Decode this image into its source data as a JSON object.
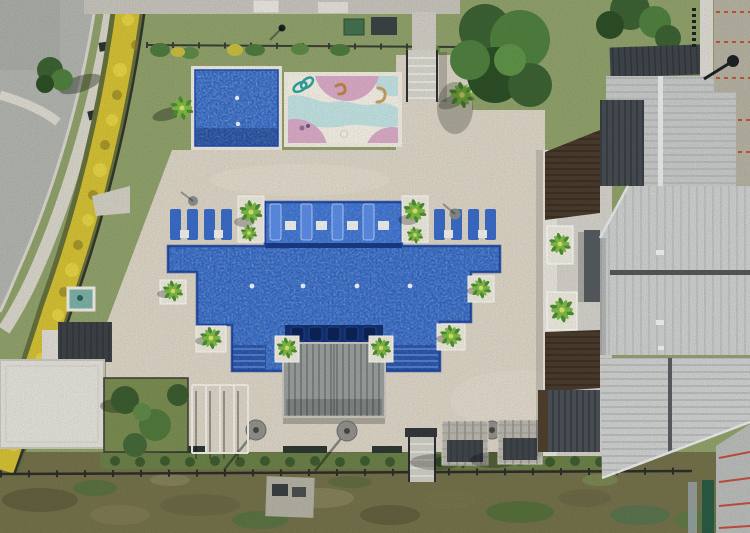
{
  "image": {
    "title": "Aerial drone photo of a residential amenity pool area",
    "view": "top-down",
    "width_px": 750,
    "height_px": 533
  },
  "palette": {
    "grass": "#90a26c",
    "scrub": "#74714b",
    "deck": "#dcd5c6",
    "road": "#b2b4af",
    "sidewalk": "#d8d5ca",
    "pool_blue": "#2a63cf",
    "pool_dark": "#16387f",
    "splash_base": "#f3efe3",
    "splash_pink": "#d9abc6",
    "splash_blue": "#c2e2e2",
    "hedge_yellow": "#d4c135",
    "hedge_green": "#66713c",
    "roof_light": "#cdd0cf",
    "roof_mid": "#c7cac9",
    "roof_dark": "#40464c",
    "roof_brown": "#4a3b2d",
    "wall_tan": "#b6b2a2",
    "white_roof": "#e3e1da",
    "spa_teal": "#7cb0a6",
    "lounger_blue": "#3b6cc8",
    "palm_green": "#6fae3c",
    "courtyard": "#d3d1c9"
  },
  "scene": {
    "objects": [
      {
        "name": "curved-road",
        "description": "light gray street curving along the upper-left with parallel sidewalk"
      },
      {
        "name": "yellow-hedge",
        "description": "curved band of yellow flowering shrubs along perimeter fence"
      },
      {
        "name": "kids-pool",
        "description": "small rectangular blue tiled pool, upper center"
      },
      {
        "name": "splash-pad",
        "description": "painted play pad with pink blobs, teal and orange squiggles"
      },
      {
        "name": "main-pool",
        "description": "large stepped blue tiled pool with tanning ledge and in-water loungers"
      },
      {
        "name": "deck-bridge",
        "description": "gray slatted deck structure crossing the lower pool edge"
      },
      {
        "name": "travertine-deck",
        "description": "beige paver pool deck"
      },
      {
        "name": "lounge-chairs",
        "description": "rows of blue sun loungers with white side tables"
      },
      {
        "name": "palm-planters",
        "description": "white square planters with palms at pool corners"
      },
      {
        "name": "clubhouse-roofs",
        "description": "light gray standing-seam metal roofs on the right"
      },
      {
        "name": "construction-wall",
        "description": "tan concrete wall with red form-tie marks, top right"
      },
      {
        "name": "perimeter-fence",
        "description": "dark metal fence with hedge along the bottom of the deck"
      },
      {
        "name": "scrub-field",
        "description": "rough dry grass strip along the bottom edge"
      }
    ]
  }
}
